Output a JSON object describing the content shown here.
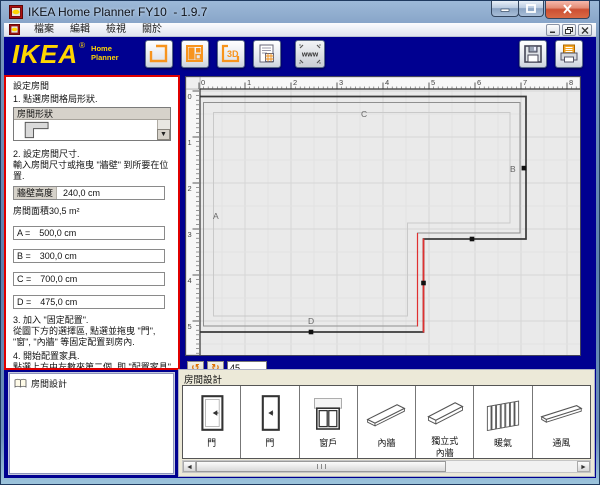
{
  "window": {
    "title": "IKEA Home Planner FY10  - 1.9.7"
  },
  "menu": {
    "items": [
      "檔案",
      "編輯",
      "檢視",
      "關於"
    ]
  },
  "toolbar": {
    "logo": {
      "main": "IKEA",
      "reg": "®",
      "sub1": "Home",
      "sub2": "Planner"
    },
    "www_label": "www"
  },
  "left_panel": {
    "title": "設定房間",
    "step1": "1. 點選房間格局形狀.",
    "shape_combo": {
      "header": "房間形狀"
    },
    "step2_title": "2. 設定房間尺寸.",
    "step2_text": "輸入房間尺寸或拖曳 \"牆壁\" 到所要在位置.",
    "wall_height": {
      "label": "牆壁高度",
      "value": "240,0 cm"
    },
    "area_label": "房間面積",
    "area_value": "30,5 m²",
    "dims": [
      {
        "label": "A =",
        "value": "500,0 cm"
      },
      {
        "label": "B =",
        "value": "300,0 cm"
      },
      {
        "label": "C =",
        "value": "700,0 cm"
      },
      {
        "label": "D =",
        "value": "475,0 cm"
      }
    ],
    "step3_title": "3. 加入 \"固定配置\".",
    "step3_text": "從圖下方的選擇區, 點選並拖曳 \"門\", \"窗\", \"內牆\" 等固定配置到房內.",
    "step4_title": "4. 開始配置家具.",
    "step4_text": "點選上方由左數來第二個, 即 \"配置家具\" 鈕, 以便開始加入IKEA產品."
  },
  "canvas": {
    "h_ruler": [
      "0",
      "1",
      "2",
      "3",
      "4",
      "5",
      "6",
      "7",
      "8"
    ],
    "v_ruler": [
      "0",
      "1",
      "2",
      "3",
      "4",
      "5"
    ],
    "wall_labels": {
      "A": "A",
      "B": "B",
      "C": "C",
      "D": "D"
    }
  },
  "rotation": {
    "value": "45"
  },
  "left_bottom_panel": {
    "title": "房間設計"
  },
  "bottom_panel": {
    "title": "房間設計",
    "items": [
      {
        "label": "門"
      },
      {
        "label": "門"
      },
      {
        "label": "窗戶"
      },
      {
        "label": "內牆"
      },
      {
        "label": "獨立式",
        "label2": "內牆"
      },
      {
        "label": "暖氣"
      },
      {
        "label": "通風"
      }
    ]
  },
  "colors": {
    "app_background": "#000090",
    "highlight_red": "#e00000",
    "logo_yellow": "#ffd500",
    "accent_orange": "#f7941d",
    "panel_beige": "#ece9d8",
    "selected_wall_red": "#e03030"
  }
}
